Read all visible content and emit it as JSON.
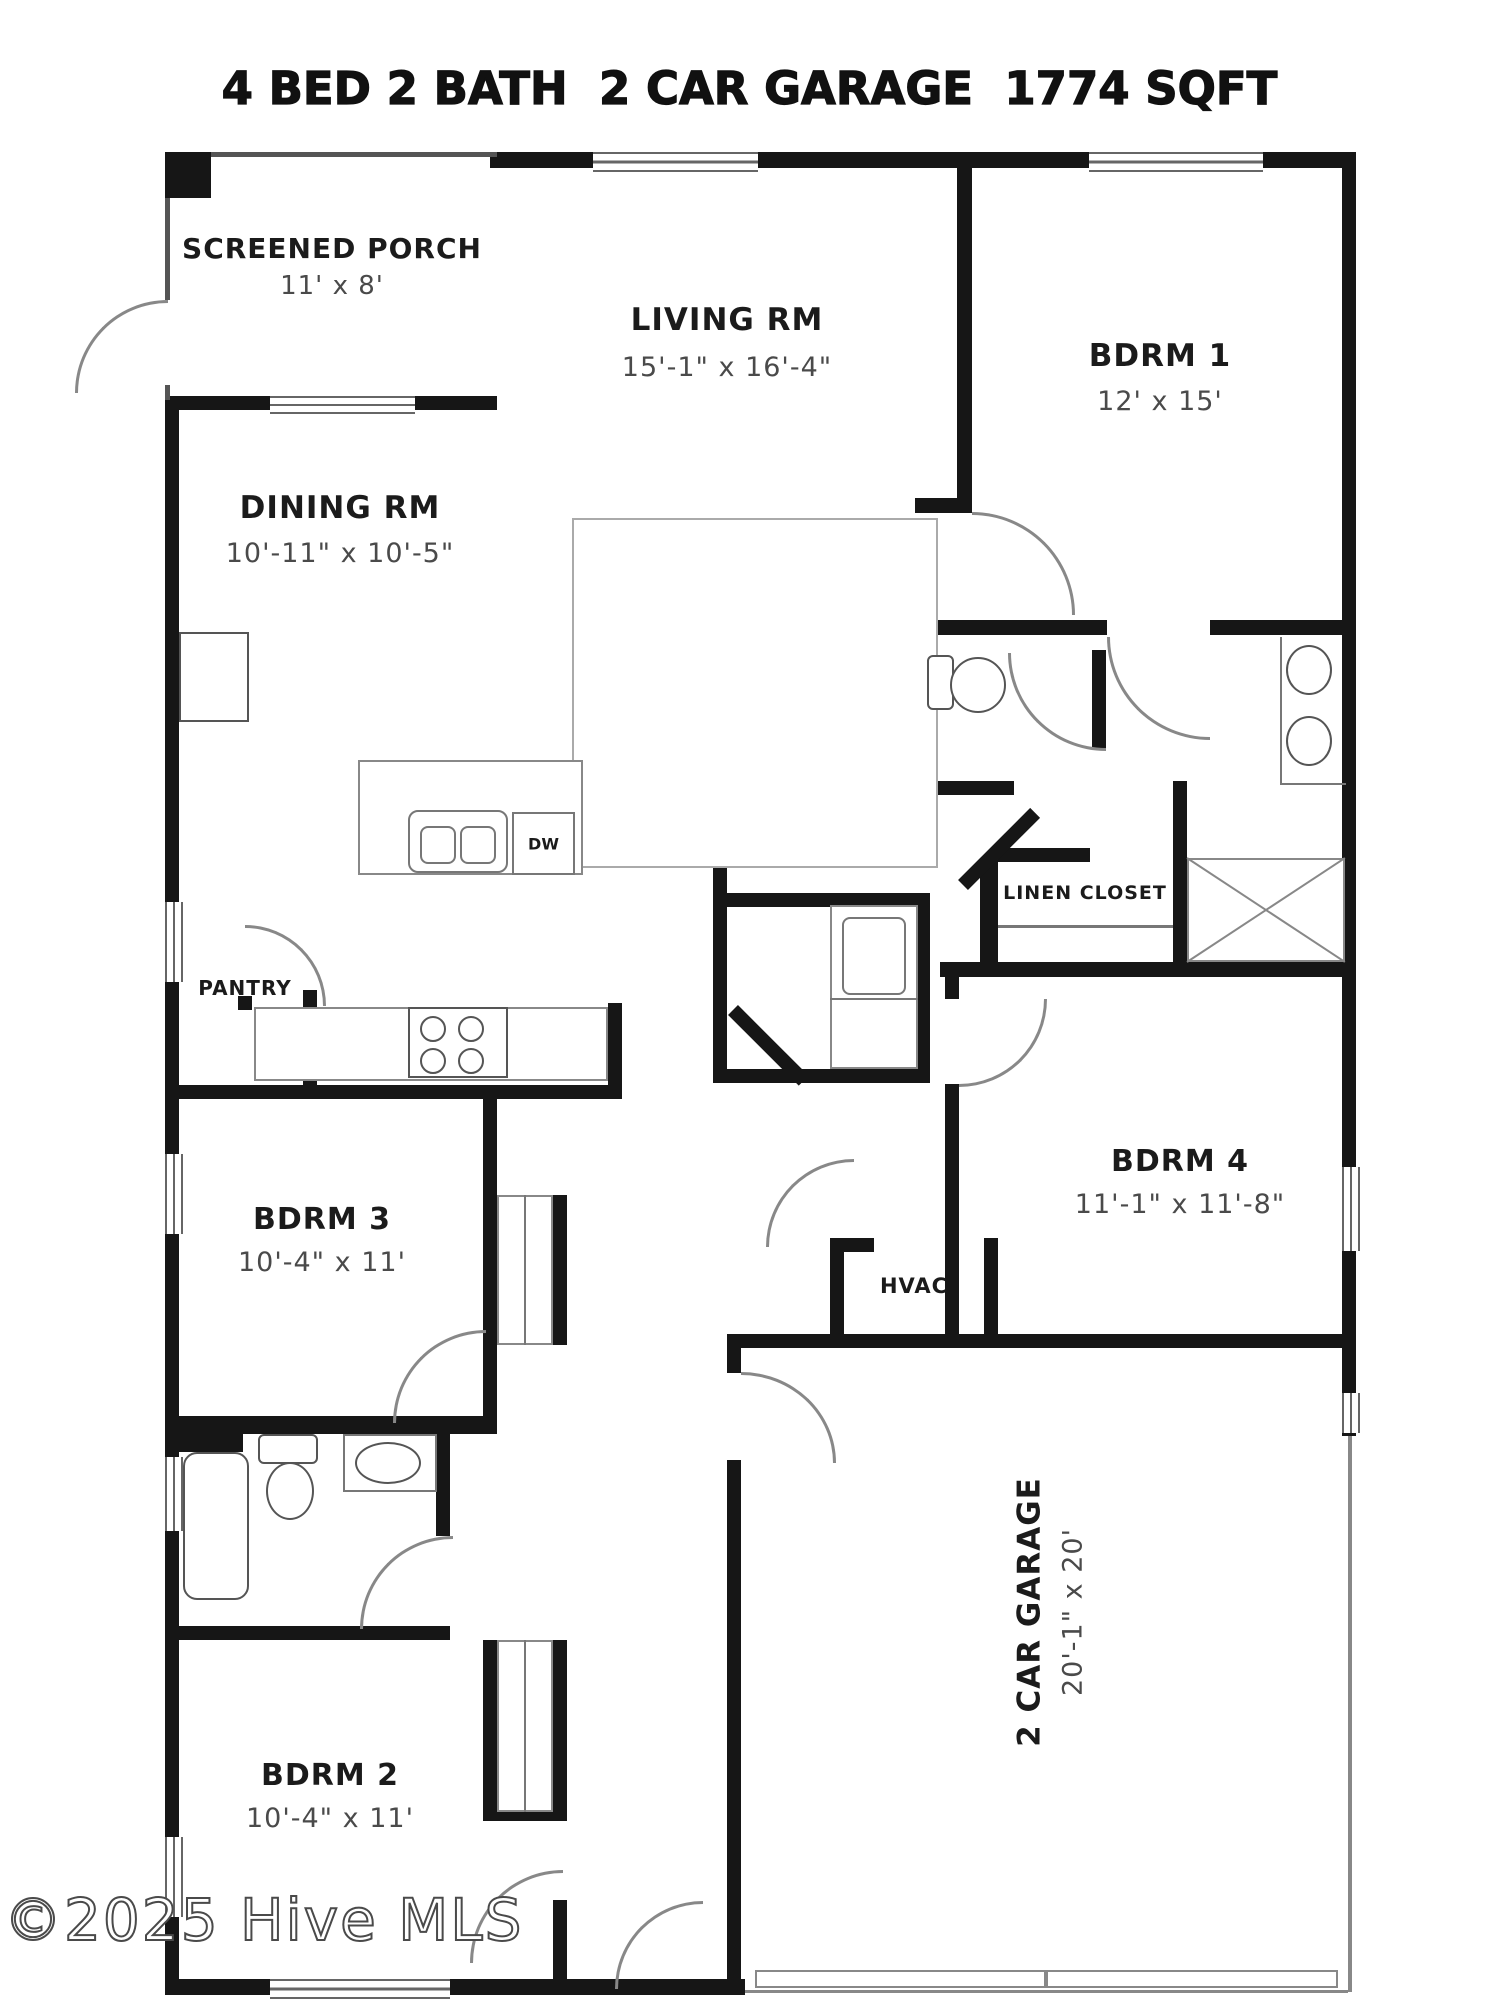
{
  "title": "4 BED 2 BATH  2 CAR GARAGE  1774 SQFT",
  "watermark": "©2025 Hive MLS",
  "rooms": {
    "screened_porch": {
      "name": "SCREENED PORCH",
      "dims": "11' x 8'"
    },
    "living": {
      "name": "LIVING RM",
      "dims": "15'-1\" x 16'-4\""
    },
    "bdrm1": {
      "name": "BDRM 1",
      "dims": "12' x 15'"
    },
    "dining": {
      "name": "DINING RM",
      "dims": "10'-11\" x 10'-5\""
    },
    "pantry": {
      "name": "PANTRY"
    },
    "linen": {
      "name": "LINEN CLOSET"
    },
    "dishwasher": {
      "name": "DW"
    },
    "bdrm3": {
      "name": "BDRM 3",
      "dims": "10'-4\" x 11'"
    },
    "bdrm4": {
      "name": "BDRM 4",
      "dims": "11'-1\" x 11'-8\""
    },
    "hvac": {
      "name": "HVAC"
    },
    "bdrm2": {
      "name": "BDRM 2",
      "dims": "10'-4\" x 11'"
    },
    "garage": {
      "name": "2 CAR GARAGE",
      "dims": "20'-1\" x 20'"
    }
  },
  "colors": {
    "wall": "#161616",
    "line": "#555555",
    "dim_text": "#4a4a4a",
    "bg": "#ffffff"
  }
}
